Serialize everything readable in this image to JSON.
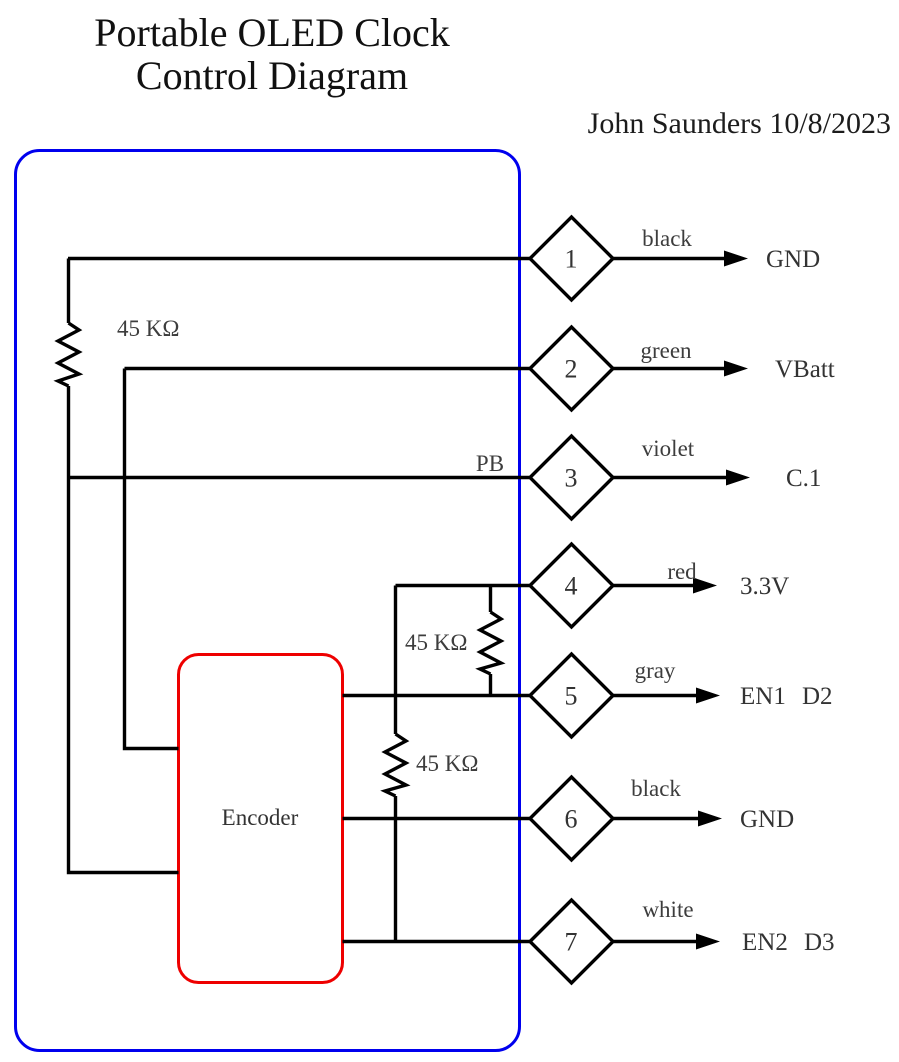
{
  "title": {
    "line1": "Portable OLED Clock",
    "line2": "Control Diagram"
  },
  "author": "John Saunders 10/8/2023",
  "encoder": {
    "label": "Encoder"
  },
  "pb_label": "PB",
  "resistors": [
    {
      "label": "45 KΩ"
    },
    {
      "label": "45 KΩ"
    },
    {
      "label": "45 KΩ"
    }
  ],
  "pins": [
    {
      "number": "1",
      "wire_color": "black",
      "signal": "GND"
    },
    {
      "number": "2",
      "wire_color": "green",
      "signal": "VBatt"
    },
    {
      "number": "3",
      "wire_color": "violet",
      "signal": "C.1"
    },
    {
      "number": "4",
      "wire_color": "red",
      "signal": "3.3V"
    },
    {
      "number": "5",
      "wire_color": "gray",
      "signal": "EN1",
      "signal2": "D2"
    },
    {
      "number": "6",
      "wire_color": "black",
      "signal": "GND"
    },
    {
      "number": "7",
      "wire_color": "white",
      "signal": "EN2",
      "signal2": "D3"
    }
  ],
  "colors": {
    "enclosure": "#0000ee",
    "encoder": "#ee0000",
    "wire": "#000000"
  }
}
